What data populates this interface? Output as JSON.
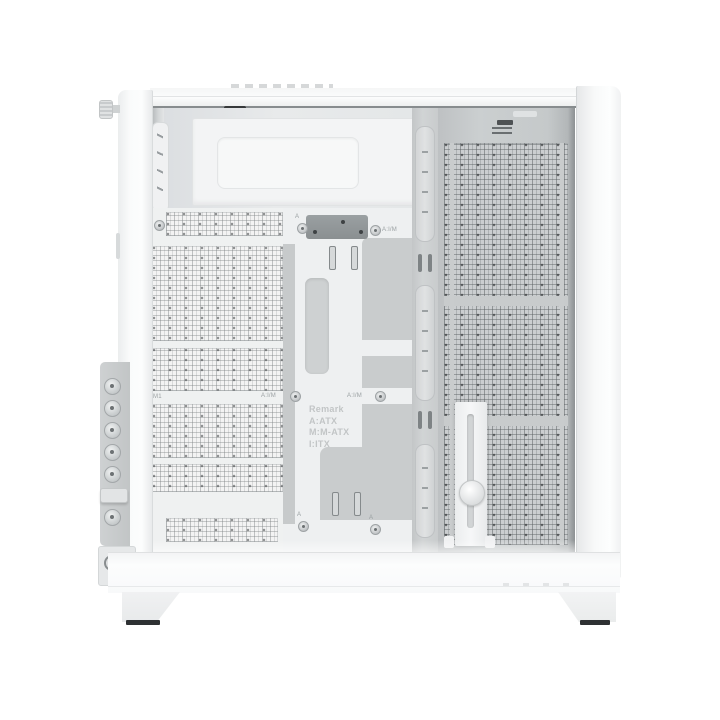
{
  "image_type": "product-photo",
  "subject": "White dual-chamber PC case, side view of open interior with perforated mesh panels, motherboard tray, cable-routing channel and GPU support bracket",
  "labels": {
    "remark": {
      "title": "Remark",
      "atx": "A:ATX",
      "matx": "M:M-ATX",
      "itx": "I:ITX"
    },
    "standoff_a": "A",
    "standoff_aim": "A:I/M",
    "fan_position": "M1"
  },
  "colors": {
    "background": "#ffffff",
    "case_white": "#fafbfb",
    "interior_gray": "#e4e7e8",
    "panel_gray": "#c8cbcc",
    "recess_gray": "#c9cccd",
    "mesh_dot": "#5a5f61",
    "foot_pad": "#2e3133"
  }
}
